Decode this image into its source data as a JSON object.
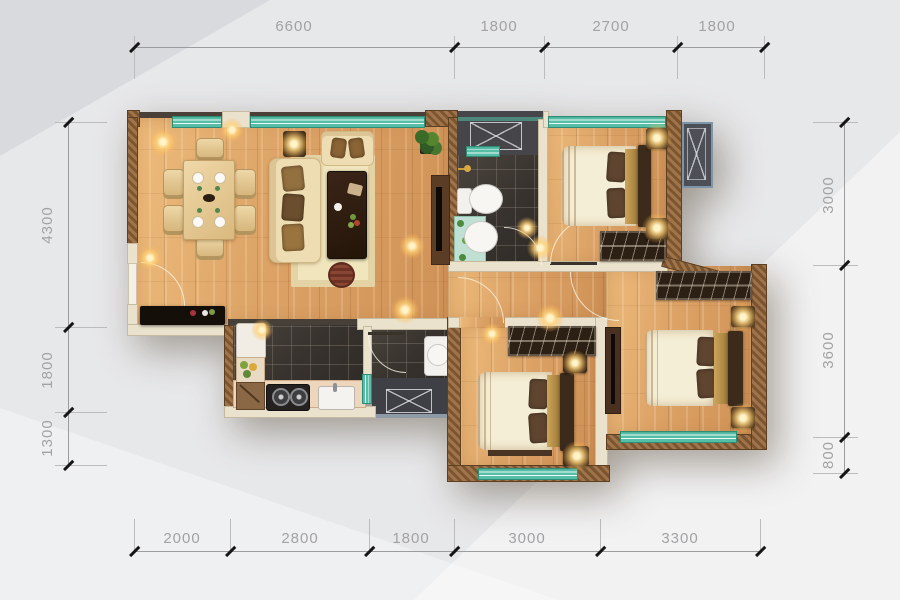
{
  "dimensions": {
    "top": [
      "6600",
      "1800",
      "2700",
      "1800"
    ],
    "bottom": [
      "2000",
      "2800",
      "1800",
      "3000",
      "3300"
    ],
    "left": [
      "4300",
      "1800",
      "1300"
    ],
    "right": [
      "3000",
      "3600",
      "800"
    ]
  },
  "colors": {
    "background": "#e7e8ea",
    "dimension_text": "#a2a2a4",
    "dimension_line": "#9c9c9e",
    "tick": "#161616",
    "exterior_wall": "#8a6239",
    "interior_wall": "#eae2cd",
    "window_teal": "#56bda6",
    "wood_floor": "#dca266",
    "tile_floor": "#37322d",
    "duct_shaft": "#45454a",
    "ac_platform_border": "#7e95a9",
    "furniture_dark": "#3a2819",
    "mattress": "#f5eed6"
  }
}
